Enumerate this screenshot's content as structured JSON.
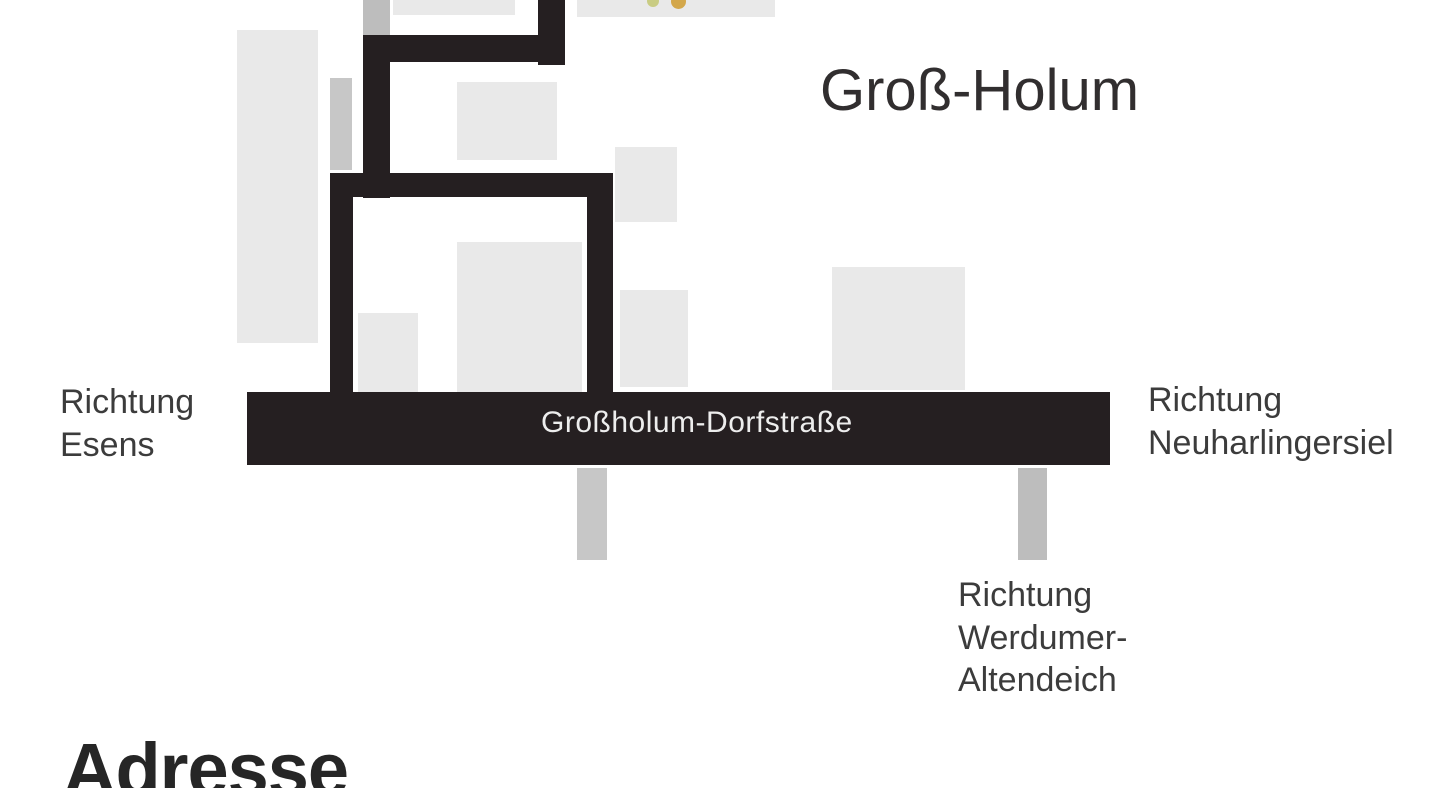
{
  "colors": {
    "background": "#ffffff",
    "road_black": "#251f21",
    "road_gray": "#c7c7c7",
    "road_gray_dark": "#bdbdbd",
    "building": "#e9e9e9",
    "text": "#3c3c3c",
    "title_text": "#312e2f",
    "road_label_text": "#ededed",
    "heading_text": "#262626",
    "dot_yellow_green": "#c9cc83",
    "dot_gold": "#d3a74b"
  },
  "map": {
    "place_label": "Groß-Holum",
    "road_label": "Großholum-Dorfstraße",
    "directions": {
      "west": {
        "line1": "Richtung",
        "line2": "Esens"
      },
      "east": {
        "line1": "Richtung",
        "line2": "Neuharlingersiel"
      },
      "south": {
        "line1": "Richtung",
        "line2": "Werdumer-",
        "line3": "Altendeich"
      }
    }
  },
  "section": {
    "heading": "Adresse"
  }
}
